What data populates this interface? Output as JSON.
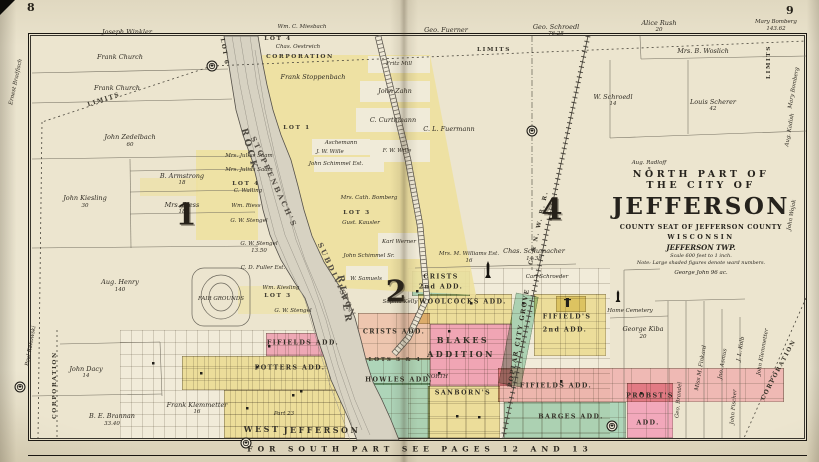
{
  "page": {
    "left_folio": "8",
    "right_folio": "9",
    "bottom_note": "FOR SOUTH PART SEE PAGES 12 AND 13"
  },
  "title_block": {
    "line1": "NORTH PART OF",
    "line2": "THE CITY OF",
    "name": "JEFFERSON",
    "county_line": "COUNTY SEAT OF JEFFERSON COUNTY",
    "state": "WISCONSIN",
    "township": "JEFFERSON TWP.",
    "scale_note": "Scale 600 feet to 1 inch.",
    "ward_note": "Note: Large shaded figures denote ward numbers.",
    "parcel_below": "George John  96 ac."
  },
  "colors": {
    "paper": "#ece5cf",
    "addition_yellow": "#eee1a0",
    "addition_pink": "#f2a8bb",
    "addition_salmon": "#eec6af",
    "addition_green": "#aed5b9",
    "river_gray": "#d7d2c2",
    "ink": "#2e2a22"
  },
  "map": {
    "river_name": "ROCK RIVER",
    "wards": [
      {
        "n": "1",
        "x": 186,
        "y": 215
      },
      {
        "n": "2",
        "x": 396,
        "y": 292
      },
      {
        "n": "4",
        "x": 552,
        "y": 210
      }
    ],
    "regions": [
      {
        "n": "west-town-grid",
        "x": 120,
        "y": 330,
        "w": 225,
        "h": 108,
        "c": "rgba(250,246,232,0.4)",
        "g": "fine",
        "zone": true
      },
      {
        "n": "east-town-grid",
        "x": 408,
        "y": 268,
        "w": 202,
        "h": 170,
        "c": "rgba(250,246,232,0.4)",
        "g": "blocks",
        "zone": true
      },
      {
        "n": "fifields-add-west",
        "x": 266,
        "y": 333,
        "w": 74,
        "h": 23,
        "c": "#f0abbc",
        "g": "fine"
      },
      {
        "n": "potters-add",
        "x": 182,
        "y": 356,
        "w": 158,
        "h": 34,
        "c": "#eee1a0",
        "g": "fine"
      },
      {
        "n": "west-jefferson",
        "x": 224,
        "y": 390,
        "w": 121,
        "h": 48,
        "c": "#eee1a0",
        "g": "fine"
      },
      {
        "n": "crists-add",
        "x": 358,
        "y": 313,
        "w": 72,
        "h": 47,
        "c": "#eec6af",
        "g": "blocks"
      },
      {
        "n": "lots-3-4",
        "x": 364,
        "y": 358,
        "w": 66,
        "h": 27,
        "c": "#aed5b9",
        "g": "blocks"
      },
      {
        "n": "howles-add",
        "x": 372,
        "y": 383,
        "w": 58,
        "h": 55,
        "c": "#aed5b9",
        "g": "blocks"
      },
      {
        "n": "crists-2nd-add",
        "x": 412,
        "y": 271,
        "w": 58,
        "h": 25,
        "c": "#aed5b9",
        "g": "blocks"
      },
      {
        "n": "woolcocks-add",
        "x": 418,
        "y": 294,
        "w": 94,
        "h": 30,
        "c": "#eee1a0",
        "g": "blocks"
      },
      {
        "n": "blakes-addition",
        "x": 430,
        "y": 324,
        "w": 82,
        "h": 62,
        "c": "#f2a8bb",
        "g": "blocks"
      },
      {
        "n": "poplar-city-grove",
        "x": 507,
        "y": 294,
        "w": 23,
        "h": 92,
        "c": "#aed5b9",
        "g": "none",
        "rot": 11
      },
      {
        "n": "fifields-2nd-add",
        "x": 534,
        "y": 294,
        "w": 72,
        "h": 62,
        "c": "#eee1a0",
        "g": "wide"
      },
      {
        "n": "fifields-add-south",
        "x": 498,
        "y": 368,
        "w": 286,
        "h": 34,
        "c": "#efb9b4",
        "g": "blocks"
      },
      {
        "n": "sanborns-add",
        "x": 428,
        "y": 386,
        "w": 72,
        "h": 52,
        "c": "#eee1a0",
        "g": "blocks"
      },
      {
        "n": "barges-add",
        "x": 504,
        "y": 402,
        "w": 122,
        "h": 36,
        "c": "#aed5b9",
        "g": "blocks"
      },
      {
        "n": "probsts-add",
        "x": 627,
        "y": 383,
        "w": 46,
        "h": 55,
        "c": "#f2a8bb",
        "g": "blocks"
      },
      {
        "n": "cemetery-lot",
        "x": 556,
        "y": 296,
        "w": 30,
        "h": 16,
        "c": "#eee1a0",
        "g": "none"
      }
    ],
    "markers": [
      {
        "x": 212,
        "y": 66
      },
      {
        "x": 532,
        "y": 131
      },
      {
        "x": 20,
        "y": 387
      },
      {
        "x": 246,
        "y": 443
      },
      {
        "x": 612,
        "y": 426
      }
    ],
    "monuments": [
      {
        "x": 488,
        "y": 278,
        "w": 6,
        "h": 17
      },
      {
        "x": 618,
        "y": 302,
        "w": 5,
        "h": 12
      }
    ],
    "labels": [
      {
        "t": "Joseph Winkler",
        "x": 127,
        "y": 32
      },
      {
        "t": "Frank Church",
        "x": 120,
        "y": 57
      },
      {
        "t": "Frank Church",
        "x": 117,
        "y": 88
      },
      {
        "t": "John Zedelbach",
        "x": 130,
        "y": 137
      },
      {
        "t": "60",
        "x": 130,
        "y": 145,
        "k": "t"
      },
      {
        "t": "B. Armstrong",
        "x": 182,
        "y": 176
      },
      {
        "t": "18",
        "x": 182,
        "y": 183,
        "k": "t"
      },
      {
        "t": "John Kiesling",
        "x": 85,
        "y": 198
      },
      {
        "t": "30",
        "x": 85,
        "y": 206,
        "k": "t"
      },
      {
        "t": "Mrs. Riess",
        "x": 182,
        "y": 205
      },
      {
        "t": "18",
        "x": 182,
        "y": 212,
        "k": "t"
      },
      {
        "t": "Aug. Henry",
        "x": 120,
        "y": 282
      },
      {
        "t": "140",
        "x": 120,
        "y": 290,
        "k": "t"
      },
      {
        "t": "John Dacy",
        "x": 86,
        "y": 369
      },
      {
        "t": "14",
        "x": 86,
        "y": 376,
        "k": "t"
      },
      {
        "t": "B. E. Brannan",
        "x": 112,
        "y": 416
      },
      {
        "t": "33.40",
        "x": 112,
        "y": 424,
        "k": "t"
      },
      {
        "t": "Frank Klemmetter",
        "x": 197,
        "y": 405
      },
      {
        "t": "16",
        "x": 197,
        "y": 412,
        "k": "t"
      },
      {
        "t": "Ernest Bradfisch",
        "x": 16,
        "y": 82,
        "k": "t",
        "r": -78
      },
      {
        "t": "Paul Rakowski",
        "x": 31,
        "y": 346,
        "k": "t",
        "r": -80
      },
      {
        "t": "Wm. C. Miesbach",
        "x": 302,
        "y": 27,
        "k": "t"
      },
      {
        "t": "LOT 4",
        "x": 278,
        "y": 39,
        "k": "r"
      },
      {
        "t": "Chas. Oestreich",
        "x": 298,
        "y": 47,
        "k": "t"
      },
      {
        "t": "Frank Stoppenbach",
        "x": 313,
        "y": 77
      },
      {
        "t": "LOT 1",
        "x": 297,
        "y": 128,
        "k": "r"
      },
      {
        "t": "Fritz Mill",
        "x": 399,
        "y": 64,
        "k": "t"
      },
      {
        "t": "John Zahn",
        "x": 395,
        "y": 91
      },
      {
        "t": "C. Curthmann",
        "x": 393,
        "y": 120
      },
      {
        "t": "Aschemann",
        "x": 341,
        "y": 143,
        "k": "t"
      },
      {
        "t": "J. W. Wille",
        "x": 330,
        "y": 152,
        "k": "t"
      },
      {
        "t": "F. W. Wille",
        "x": 397,
        "y": 151,
        "k": "t"
      },
      {
        "t": "John Schimmel Est.",
        "x": 336,
        "y": 164,
        "k": "t"
      },
      {
        "t": "Mrs. Julius Saam",
        "x": 249,
        "y": 156,
        "k": "t"
      },
      {
        "t": "Mrs. Julius Saam",
        "x": 249,
        "y": 170,
        "k": "t"
      },
      {
        "t": "LOT 4",
        "x": 246,
        "y": 184,
        "k": "r"
      },
      {
        "t": "C. Walling",
        "x": 248,
        "y": 191,
        "k": "t"
      },
      {
        "t": "Wm. Riess",
        "x": 246,
        "y": 206,
        "k": "t"
      },
      {
        "t": "G. W. Stengel",
        "x": 249,
        "y": 221,
        "k": "t"
      },
      {
        "t": "G. W. Stengel",
        "x": 259,
        "y": 244,
        "k": "t"
      },
      {
        "t": "13.50",
        "x": 259,
        "y": 251,
        "k": "t"
      },
      {
        "t": "C. D. Fuller Est.",
        "x": 263,
        "y": 268,
        "k": "t"
      },
      {
        "t": "Wm. Kiesling",
        "x": 281,
        "y": 288,
        "k": "t"
      },
      {
        "t": "LOT 3",
        "x": 278,
        "y": 296,
        "k": "r"
      },
      {
        "t": "G. W. Stengel",
        "x": 293,
        "y": 311,
        "k": "t"
      },
      {
        "t": "Mrs. Cath. Bomberg",
        "x": 369,
        "y": 198,
        "k": "t"
      },
      {
        "t": "LOT 3",
        "x": 357,
        "y": 213,
        "k": "r"
      },
      {
        "t": "Gust. Kausler",
        "x": 361,
        "y": 223,
        "k": "t"
      },
      {
        "t": "Karl Werner",
        "x": 399,
        "y": 242,
        "k": "t"
      },
      {
        "t": "John Schimmel Sr.",
        "x": 369,
        "y": 256,
        "k": "t"
      },
      {
        "t": "W. Samuels",
        "x": 366,
        "y": 279,
        "k": "t"
      },
      {
        "t": "Sophia Kelly",
        "x": 400,
        "y": 302,
        "k": "t"
      },
      {
        "t": "ROCK",
        "x": 249,
        "y": 150,
        "k": "riv",
        "r": 75
      },
      {
        "t": "RIVER",
        "x": 344,
        "y": 300,
        "k": "riv",
        "r": 80
      },
      {
        "t": "STOPPENBACH'S",
        "x": 274,
        "y": 182,
        "k": "sub",
        "r": 65
      },
      {
        "t": "SUBDIVISION",
        "x": 337,
        "y": 280,
        "k": "sub",
        "r": 65
      },
      {
        "t": "LOT 6",
        "x": 224,
        "y": 52,
        "k": "r",
        "r": 80
      },
      {
        "t": "CORPORATION",
        "x": 300,
        "y": 57,
        "k": "r"
      },
      {
        "t": "LIMITS",
        "x": 494,
        "y": 50,
        "k": "r"
      },
      {
        "t": "LIMITS",
        "x": 104,
        "y": 100,
        "k": "r",
        "r": -18
      },
      {
        "t": "CORPORATION",
        "x": 55,
        "y": 385,
        "k": "r",
        "r": -90
      },
      {
        "t": "FAIR GROUNDS",
        "x": 221,
        "y": 299,
        "k": "t"
      },
      {
        "t": "Geo. Fuerner",
        "x": 446,
        "y": 30
      },
      {
        "t": "Geo. Schroedl",
        "x": 556,
        "y": 27
      },
      {
        "t": "76.25",
        "x": 556,
        "y": 34,
        "k": "t"
      },
      {
        "t": "Alice Rush",
        "x": 659,
        "y": 23
      },
      {
        "t": "20",
        "x": 659,
        "y": 30,
        "k": "t"
      },
      {
        "t": "Mrs. B. Woslich",
        "x": 703,
        "y": 51
      },
      {
        "t": "W. Schroedl",
        "x": 613,
        "y": 97
      },
      {
        "t": "14",
        "x": 613,
        "y": 104,
        "k": "t"
      },
      {
        "t": "Louis Scherer",
        "x": 713,
        "y": 102
      },
      {
        "t": "42",
        "x": 713,
        "y": 109,
        "k": "t"
      },
      {
        "t": "Mary Bomberg",
        "x": 776,
        "y": 22,
        "k": "t"
      },
      {
        "t": "143.62",
        "x": 776,
        "y": 29,
        "k": "t"
      },
      {
        "t": "LIMITS",
        "x": 769,
        "y": 62,
        "k": "r",
        "r": -90
      },
      {
        "t": "Mary Bomberg",
        "x": 794,
        "y": 88,
        "k": "t",
        "r": -80
      },
      {
        "t": "Aug. Kadish",
        "x": 790,
        "y": 130,
        "k": "t",
        "r": -80
      },
      {
        "t": "John Wojak",
        "x": 792,
        "y": 215,
        "k": "t",
        "r": -80
      },
      {
        "t": "Aug. Radloff",
        "x": 649,
        "y": 163,
        "k": "t"
      },
      {
        "t": "5",
        "x": 649,
        "y": 170,
        "k": "t"
      },
      {
        "t": "C. L. Fuermann",
        "x": 449,
        "y": 129
      },
      {
        "t": "C. & N. W. R. R.",
        "x": 539,
        "y": 228,
        "k": "r",
        "r": -78
      },
      {
        "t": "Mrs. M. Williams Est.",
        "x": 469,
        "y": 254,
        "k": "t"
      },
      {
        "t": "16",
        "x": 469,
        "y": 261,
        "k": "t"
      },
      {
        "t": "Chas. Schumacher",
        "x": 534,
        "y": 251
      },
      {
        "t": "14.38",
        "x": 534,
        "y": 259,
        "k": "t"
      },
      {
        "t": "Carl Schroeder",
        "x": 547,
        "y": 277,
        "k": "t"
      },
      {
        "t": "George Kiba",
        "x": 643,
        "y": 329
      },
      {
        "t": "20",
        "x": 643,
        "y": 337,
        "k": "t"
      },
      {
        "t": "Home Cemetery",
        "x": 630,
        "y": 311,
        "k": "t"
      },
      {
        "t": "Miss M. Finkard",
        "x": 701,
        "y": 368,
        "k": "t",
        "r": -80
      },
      {
        "t": "Jno. Asmus",
        "x": 723,
        "y": 364,
        "k": "t",
        "r": -80
      },
      {
        "t": "J. L. Kolb",
        "x": 741,
        "y": 349,
        "k": "t",
        "r": -80
      },
      {
        "t": "John Klemmetter",
        "x": 763,
        "y": 352,
        "k": "t",
        "r": -80
      },
      {
        "t": "CORPORATION",
        "x": 779,
        "y": 370,
        "k": "r",
        "r": -62
      },
      {
        "t": "John Fischer",
        "x": 734,
        "y": 407,
        "k": "t",
        "r": -85
      },
      {
        "t": "Geo. Brandel",
        "x": 679,
        "y": 400,
        "k": "t",
        "r": -85
      },
      {
        "t": "NORTH",
        "x": 437,
        "y": 377,
        "k": "t"
      },
      {
        "t": "Part 23",
        "x": 284,
        "y": 414,
        "k": "t"
      },
      {
        "t": "FIFIELDS  ADD.",
        "x": 303,
        "y": 343,
        "k": "a2"
      },
      {
        "t": "POTTERS  ADD.",
        "x": 290,
        "y": 368,
        "k": "a2"
      },
      {
        "t": "WEST",
        "x": 262,
        "y": 429,
        "k": "a"
      },
      {
        "t": "JEFFERSON",
        "x": 322,
        "y": 430,
        "k": "a"
      },
      {
        "t": "CRISTS  ADD.",
        "x": 394,
        "y": 332,
        "k": "a2"
      },
      {
        "t": "LOTS 3 & 4",
        "x": 395,
        "y": 360,
        "k": "r"
      },
      {
        "t": "HOWLES  ADD.",
        "x": 399,
        "y": 380,
        "k": "a2"
      },
      {
        "t": "BLAKES",
        "x": 463,
        "y": 340,
        "k": "a"
      },
      {
        "t": "ADDITION",
        "x": 461,
        "y": 354,
        "k": "a"
      },
      {
        "t": "WOOLCOCKS  ADD.",
        "x": 463,
        "y": 302,
        "k": "a2"
      },
      {
        "t": "CRISTS",
        "x": 441,
        "y": 277,
        "k": "a2"
      },
      {
        "t": "2nd  ADD.",
        "x": 441,
        "y": 287,
        "k": "a2"
      },
      {
        "t": "POPLAR CITY GROVE",
        "x": 519,
        "y": 338,
        "k": "a2",
        "r": -80
      },
      {
        "t": "FIFIELD'S",
        "x": 567,
        "y": 317,
        "k": "a2"
      },
      {
        "t": "2nd  ADD.",
        "x": 565,
        "y": 330,
        "k": "a2"
      },
      {
        "t": "FIFIELDS  ADD.",
        "x": 556,
        "y": 386,
        "k": "a2"
      },
      {
        "t": "SANBORN'S",
        "x": 463,
        "y": 393,
        "k": "a2"
      },
      {
        "t": "BARGES  ADD.",
        "x": 571,
        "y": 417,
        "k": "a2"
      },
      {
        "t": "PROBST'S",
        "x": 650,
        "y": 396,
        "k": "a2"
      },
      {
        "t": "ADD.",
        "x": 648,
        "y": 423,
        "k": "a2"
      }
    ]
  }
}
